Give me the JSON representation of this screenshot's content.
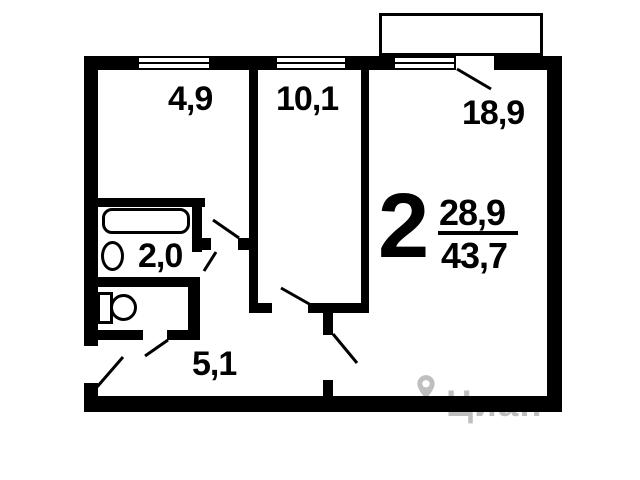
{
  "plan": {
    "type": "apartment-floor-plan",
    "rooms": {
      "kitchen": {
        "area": "4,9"
      },
      "room_small": {
        "area": "10,1"
      },
      "room_large": {
        "area": "18,9"
      },
      "bathroom": {
        "area": "2,0"
      },
      "hallway": {
        "area": "5,1"
      }
    },
    "summary": {
      "rooms_count": "2",
      "living_area": "28,9",
      "total_area": "43,7"
    }
  },
  "watermark": {
    "label": "Циан",
    "icon": "map-pin-icon"
  },
  "colors": {
    "walls": "#000000",
    "background": "#ffffff",
    "watermark_gray": "#c4c4c4"
  }
}
